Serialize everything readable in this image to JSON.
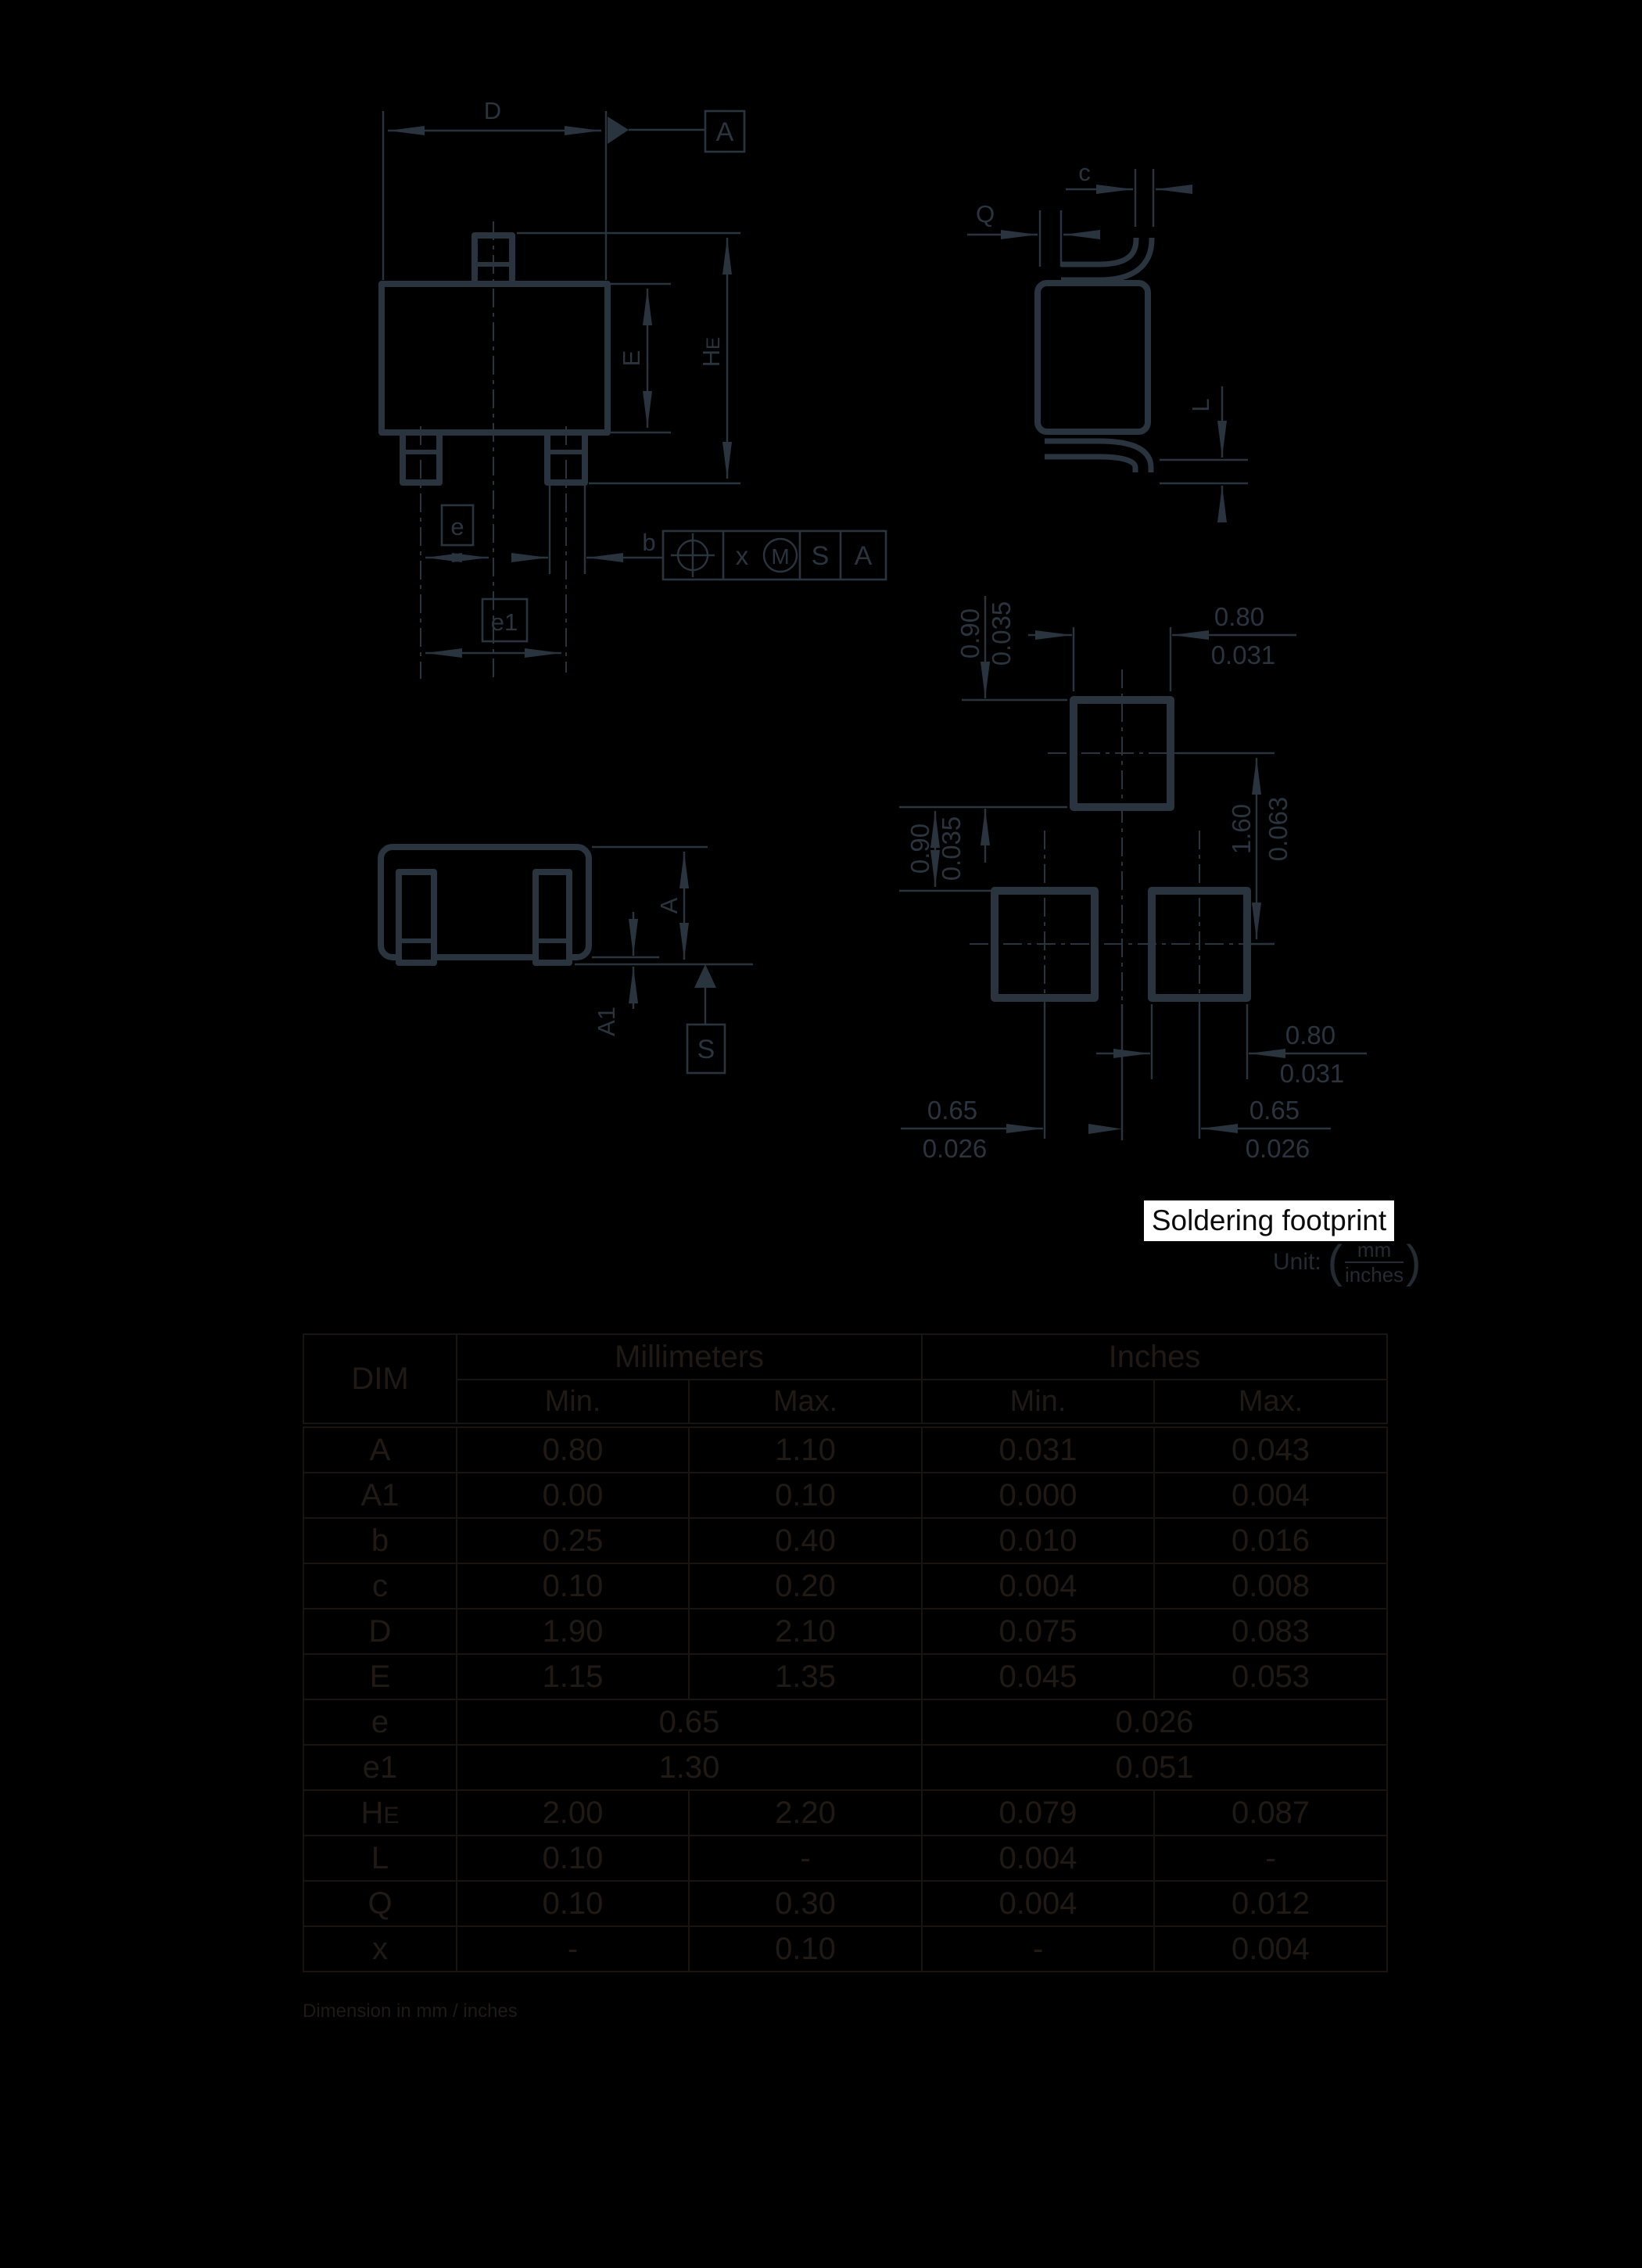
{
  "top_view": {
    "dim_d": "D",
    "datum_a": "A",
    "dim_e": "E",
    "dim_he_h": "H",
    "dim_he_e": "E",
    "dim_e_box": "e",
    "dim_e1_box": "e1",
    "dim_b": "b",
    "fcf": {
      "x": "x",
      "m": "M",
      "s": "S",
      "a": "A"
    }
  },
  "side_view": {
    "dim_c": "c",
    "dim_q": "Q",
    "dim_l": "L"
  },
  "front_view": {
    "dim_a": "A",
    "dim_a1": "A1",
    "datum_s": "S"
  },
  "footprint": {
    "label": "Soldering footprint",
    "unit_label": "Unit:",
    "unit_mm": "mm",
    "unit_inches": "inches",
    "top_width_mm": "0.80",
    "top_width_in": "0.031",
    "top_pad_h_mm": "0.90",
    "top_pad_h_in": "0.035",
    "gap_mm": "0.90",
    "gap_in": "0.035",
    "row_pitch_mm": "1.60",
    "row_pitch_in": "0.063",
    "bot_width_mm": "0.80",
    "bot_width_in": "0.031",
    "pitch_left_mm": "0.65",
    "pitch_left_in": "0.026",
    "pitch_right_mm": "0.65",
    "pitch_right_in": "0.026"
  },
  "table": {
    "col_dim": "DIM",
    "col_mm": "Millimeters",
    "col_in": "Inches",
    "min": "Min.",
    "max": "Max.",
    "rows": [
      {
        "dim": "A",
        "cells": [
          "0.80",
          "1.10",
          "0.031",
          "0.043"
        ]
      },
      {
        "dim": "A1",
        "cells": [
          "0.00",
          "0.10",
          "0.000",
          "0.004"
        ]
      },
      {
        "dim": "b",
        "cells": [
          "0.25",
          "0.40",
          "0.010",
          "0.016"
        ]
      },
      {
        "dim": "c",
        "cells": [
          "0.10",
          "0.20",
          "0.004",
          "0.008"
        ]
      },
      {
        "dim": "D",
        "cells": [
          "1.90",
          "2.10",
          "0.075",
          "0.083"
        ]
      },
      {
        "dim": "E",
        "cells": [
          "1.15",
          "1.35",
          "0.045",
          "0.053"
        ]
      },
      {
        "dim": "e",
        "span": true,
        "cells": [
          "0.65",
          "0.026"
        ]
      },
      {
        "dim": "e1",
        "span": true,
        "cells": [
          "1.30",
          "0.051"
        ]
      },
      {
        "dim": "H",
        "dim_sub": "E",
        "cells": [
          "2.00",
          "2.20",
          "0.079",
          "0.087"
        ]
      },
      {
        "dim": "L",
        "cells": [
          "0.10",
          "-",
          "0.004",
          "-"
        ]
      },
      {
        "dim": "Q",
        "cells": [
          "0.10",
          "0.30",
          "0.004",
          "0.012"
        ]
      },
      {
        "dim": "x",
        "cells": [
          "-",
          "0.10",
          "-",
          "0.004"
        ]
      }
    ]
  },
  "caption": "Dimension in mm / inches"
}
